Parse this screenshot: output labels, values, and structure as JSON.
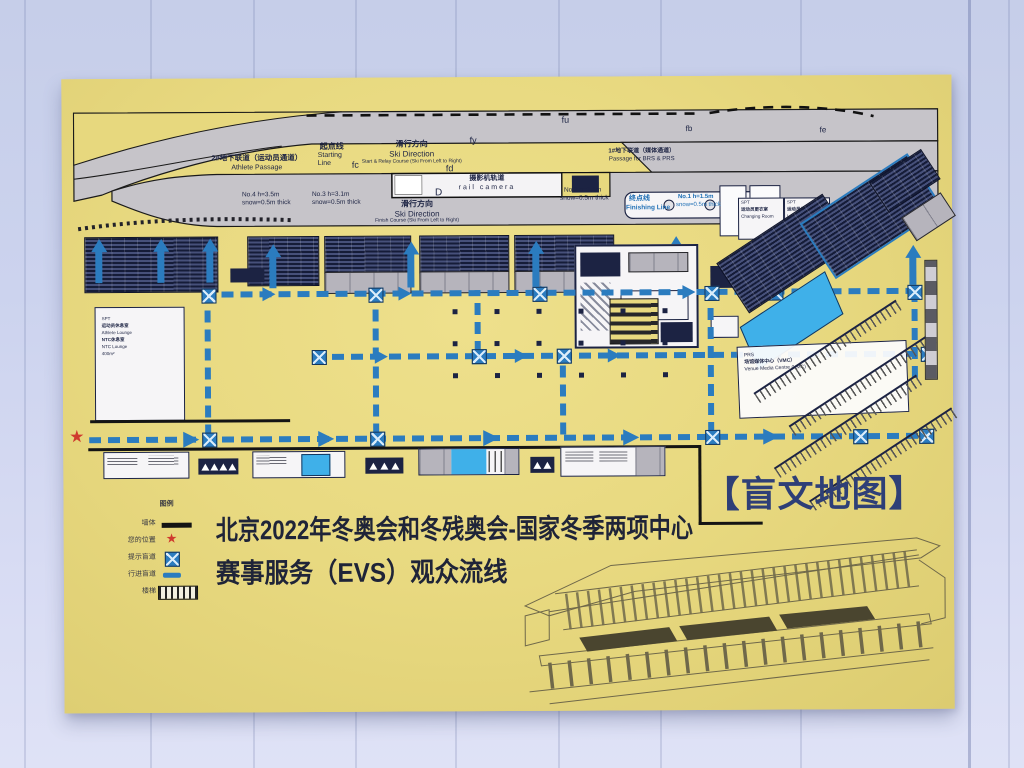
{
  "poster": {
    "title_line1": "北京2022年冬奥会和冬残奥会-国家冬季两项中心",
    "title_line2": "赛事服务（EVS）观众流线",
    "braille_tag": "【盲文地图】"
  },
  "legend": {
    "header": "图例",
    "star_glyph": "★",
    "items": [
      {
        "label": "墙体",
        "symbol": "wall-line"
      },
      {
        "label": "您的位置",
        "symbol": "location-star"
      },
      {
        "label": "提示盲道",
        "symbol": "warning-tactile-paving"
      },
      {
        "label": "行进盲道",
        "symbol": "guiding-tactile-paving"
      },
      {
        "label": "楼梯",
        "symbol": "stairs"
      }
    ]
  },
  "track": {
    "athlete_passage_cn": "2#地下联道（运动员通道）",
    "athlete_passage_en": "Athlete Passage",
    "starting_line_cn": "起点线",
    "starting_line_en": "Starting Line",
    "ski_dir_start_cn": "滑行方向",
    "ski_dir_start_en": "Ski Direction",
    "ski_dir_start_sub": "Start & Relay Course (Ski From Left to Right)",
    "rail_camera_cn": "摄影机轨道",
    "rail_camera_en": "rail camera",
    "ski_dir_finish_cn": "滑行方向",
    "ski_dir_finish_en": "Ski Direction",
    "ski_dir_finish_sub": "Finish Course (Ski From Left to Right)",
    "media_passage_cn": "1#地下联道（媒体通道）",
    "media_passage_en": "Passage for BRS & PRS",
    "finish_line_cn": "终点线",
    "finish_line_en": "Finishing Line",
    "no1": "No.1 h=1.5m",
    "no1_snow": "snow=0.5m thick",
    "no2": "No.2 h=1.1m",
    "no2_snow": "snow=0.5m thick",
    "no3": "No.3 h=3.1m",
    "no3_snow": "snow=0.5m thick",
    "no4": "No.4 h=3.5m",
    "no4_snow": "snow=0.5m thick",
    "points": {
      "fu": "fu",
      "fy": "fy",
      "fc": "fc",
      "fd": "fd",
      "d": "D",
      "fb": "fb",
      "fe": "fe"
    }
  },
  "rooms": {
    "ntc_lounge": {
      "l1": "SPT",
      "l2": "运动员休息室",
      "l3": "Athlete Lounge",
      "l4": "NTC休息室",
      "l5": "NTC Lounge",
      "l6": "400m²"
    },
    "changing_room": {
      "l1": "SPT",
      "l2": "运动员更衣室",
      "l3": "Changing Room"
    },
    "athlete_lounge2": {
      "l1": "SPT",
      "l2": "运动员休息室",
      "l3": "Lounge"
    },
    "vmc": {
      "l1": "PRS",
      "l2": "场馆媒体中心（VMC）",
      "l3": "Venue Media Centre (VMC)"
    }
  }
}
